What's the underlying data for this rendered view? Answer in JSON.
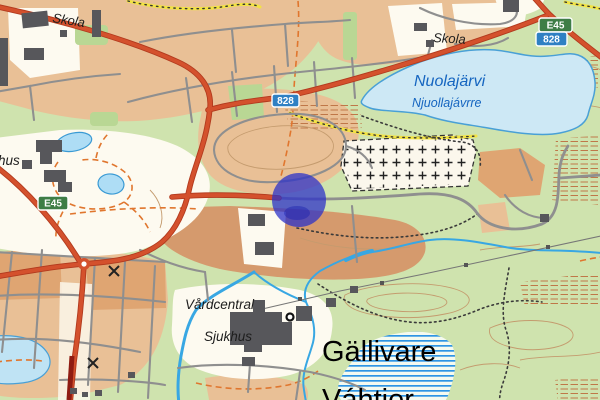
{
  "map": {
    "labels": {
      "skola_nw": "Skola",
      "skola_ne": "Skola",
      "hus": "hus",
      "lake_name": "Nuolajärvi",
      "lake_name_sami": "Njuollajávrre",
      "vardcentral": "Vårdcentral",
      "sjukhus": "Sjukhus",
      "town": "Gällivare",
      "town_sami": "Váhtjer"
    },
    "road_signs": {
      "e45_left": "E45",
      "r828_mid": "828",
      "e45_ne": "E45",
      "r828_ne": "828"
    },
    "marker": {
      "cx": 299,
      "cy": 200,
      "r": 27
    },
    "colors": {
      "forest": "#cfe3ae",
      "forest_dark": "#b9d794",
      "residential": "#e9c096",
      "residential_dark": "#dfa572",
      "field": "#d59a6d",
      "open_cream": "#fdfaf0",
      "lake": "#cde8f5",
      "lake_outline": "#49a0d6",
      "pond": "#aeddf5",
      "road_red": "#d4512d",
      "road_casing": "#b23a1e",
      "bridge_red": "#8f1c12",
      "street_gray": "#8f8f8f",
      "building": "#57575b",
      "contour": "#c49b6e",
      "stream": "#38a7e3",
      "marker_blue": "#2b30c9",
      "sign_green": "#3e7d46",
      "sign_blue": "#2f80c3",
      "trail_yellow": "#f2e343",
      "trail_orange": "#e0762e",
      "label_blue": "#1565c0",
      "wetland_stripe": "#2e95e4",
      "hatch_brown": "#bf7748"
    }
  }
}
